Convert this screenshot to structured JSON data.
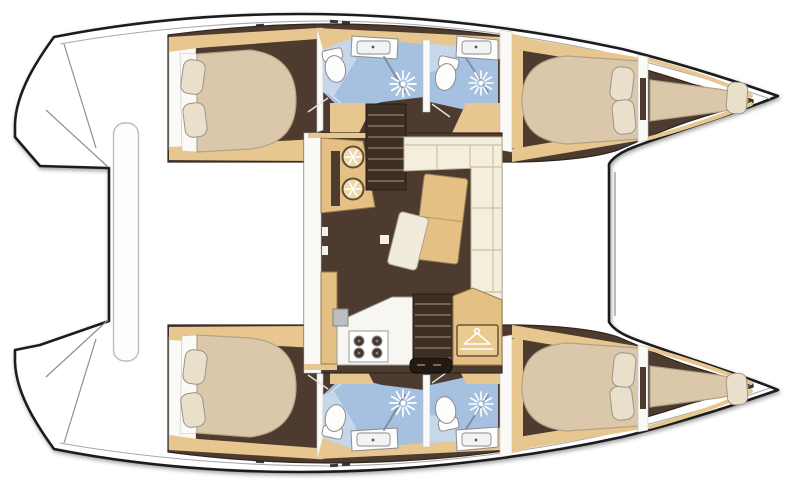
{
  "diagram_type": "catamaran-interior-deck-plan",
  "orientation": {
    "bow": "right",
    "stern": "left"
  },
  "colors": {
    "outline": "#1c1c1c",
    "deckline": "#a8a8a8",
    "floor": "#4e3b30",
    "trim": "#e7c68f",
    "counter": "#e4c084",
    "wall": "#fbfaf7",
    "bed": "#dbc8ab",
    "bedline": "#b3a286",
    "pillow": "#eadfcb",
    "sofa": "#f4eedc",
    "bath": "#a6c0e0",
    "bathlight": "#c6d7ec",
    "fixture": "#fdfdfc",
    "stair": "#3e2f25",
    "tread": "#8a7460",
    "glass": "#7f8fa6"
  },
  "regions": {
    "port_hull": [
      "aft-cabin",
      "aft-head",
      "forward-head",
      "forward-cabin",
      "bow-berth"
    ],
    "starboard_hull": [
      "aft-cabin",
      "aft-head",
      "forward-head",
      "forward-cabin",
      "bow-berth"
    ],
    "saloon": [
      "galley-sink-counter",
      "port-companionway-stairs",
      "dinette-sofa",
      "dinette-table",
      "loose-chair",
      "galley-stove-counter",
      "starboard-companionway-stairs",
      "wardrobe"
    ],
    "exterior": [
      "port-transom-steps",
      "starboard-transom-steps",
      "aft-beam",
      "foredeck"
    ]
  },
  "counts": {
    "double_cabins": 4,
    "bow_berths": 2,
    "toilets": 4,
    "showers": 4,
    "bathroom_sinks": 4,
    "galley_sinks": 2,
    "stove_burners": 4
  },
  "icons": {
    "shower": "sunburst-rays",
    "toilet": "oval-bowl-with-tank",
    "sink": "rect-basin-with-drain-dot",
    "galley_sink": "round-ring-with-spokes",
    "stove": "four-burner-hob",
    "wardrobe": "coat-hanger",
    "stairs": "companionway-treads",
    "bed": "mattress-with-pillows"
  }
}
